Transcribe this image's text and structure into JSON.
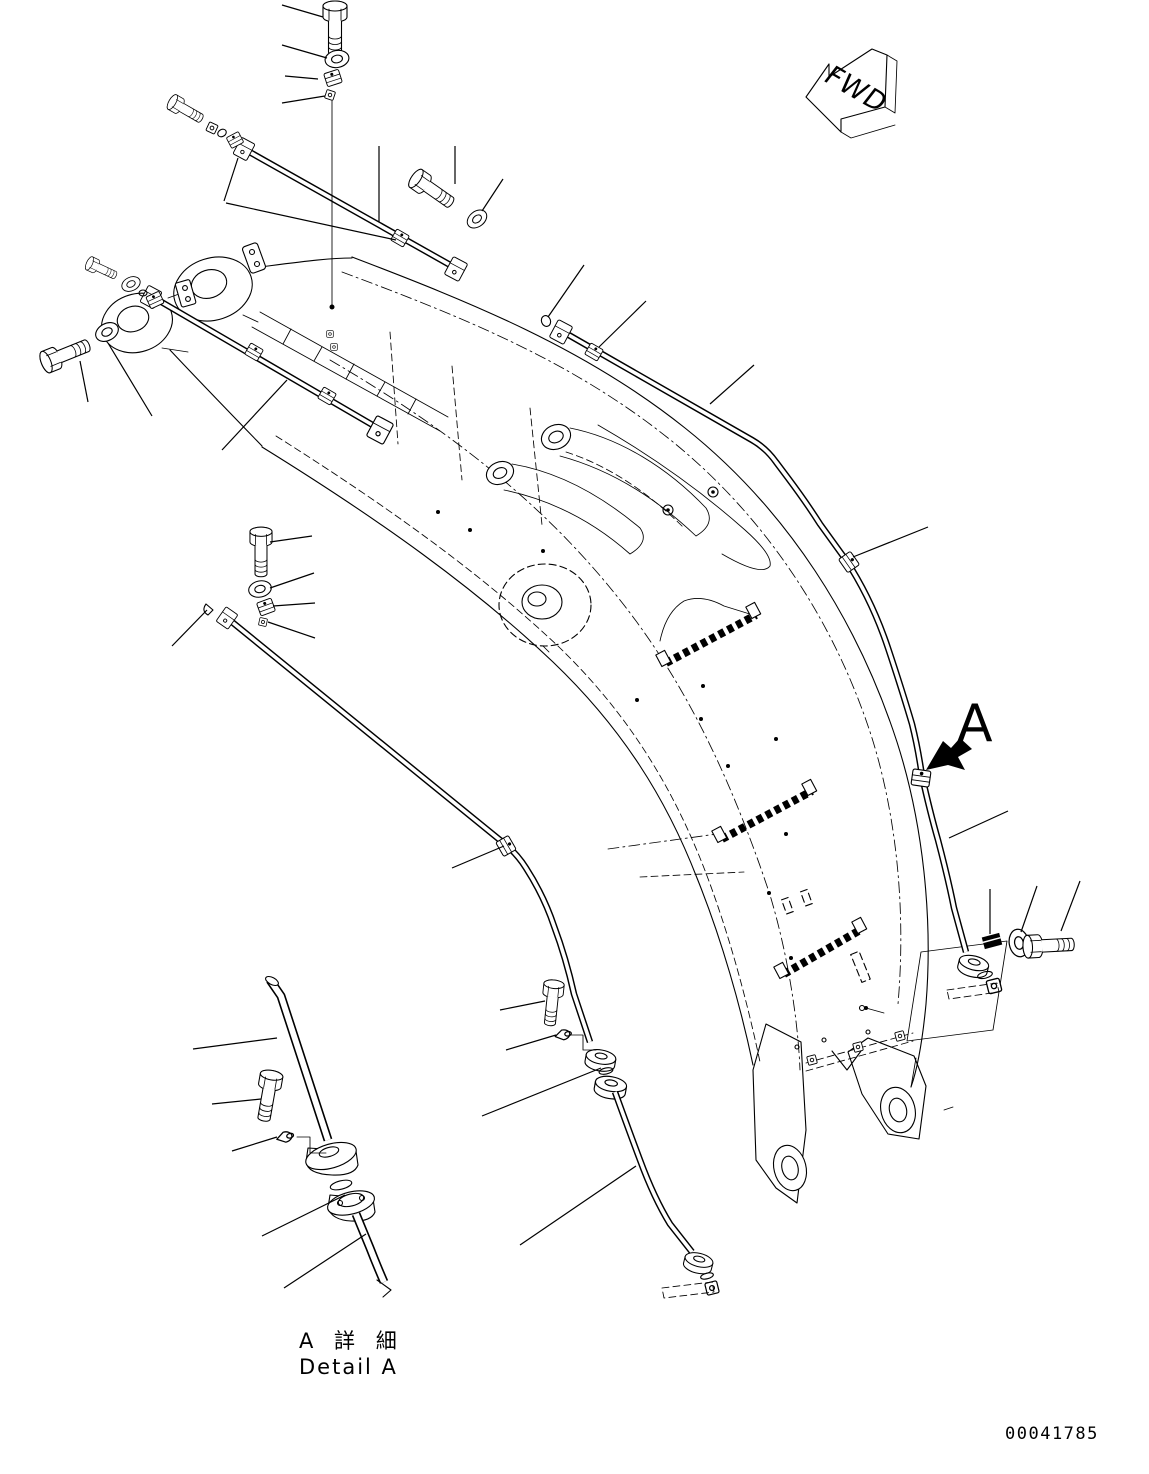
{
  "colors": {
    "background": "#ffffff",
    "ink": "#000000"
  },
  "labels": {
    "fwd_arrow": "FWD",
    "detail_marker": "A",
    "detail_caption_jp": "A 詳 細",
    "detail_caption_en": "Detail A",
    "drawing_number": "00041785"
  },
  "figure": {
    "view_marker": "A",
    "callout_count": 36
  }
}
